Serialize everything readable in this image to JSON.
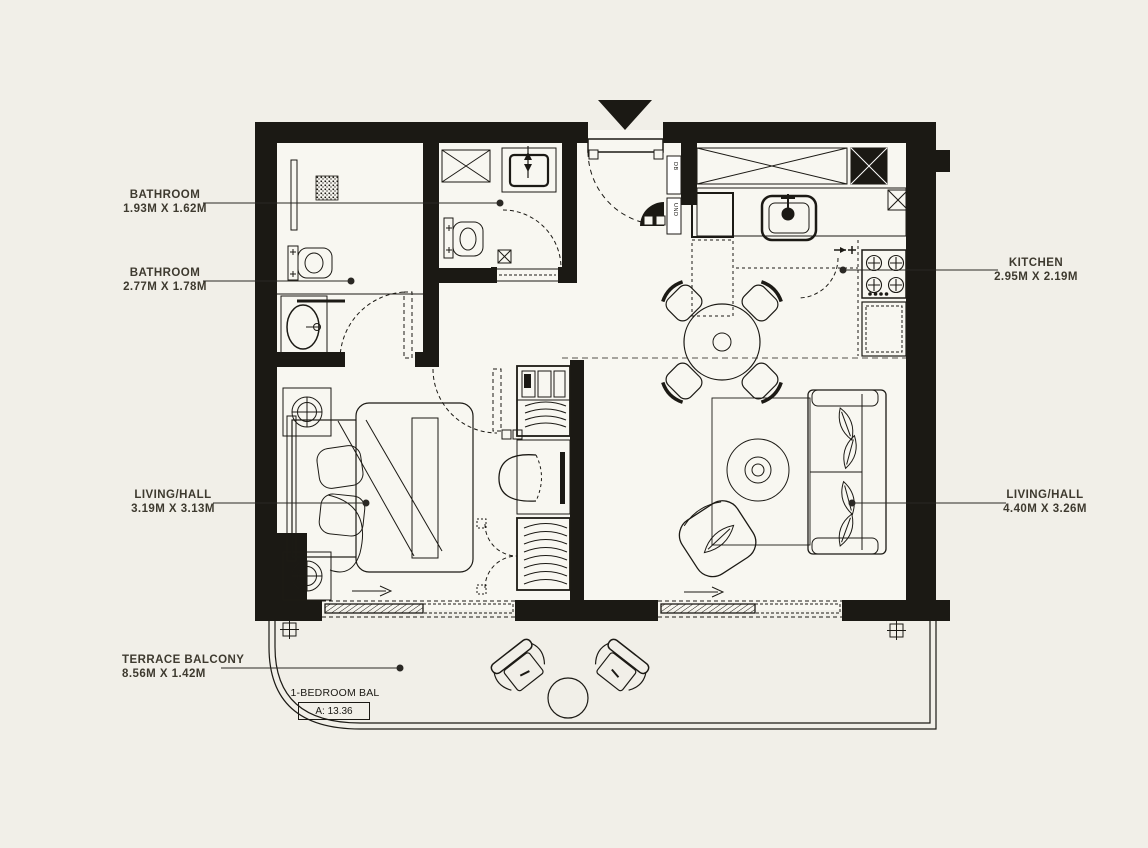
{
  "meta": {
    "type": "apartment-floor-plan",
    "background_color": "#f1efe8",
    "ink_color": "#1b1914",
    "label_color": "#3e3a2f"
  },
  "labels": {
    "bathroom1": {
      "name": "BATHROOM",
      "dims": "1.93M X 1.62M"
    },
    "bathroom2": {
      "name": "BATHROOM",
      "dims": "2.77M X 1.78M"
    },
    "living_hall_left": {
      "name": "LIVING/HALL",
      "dims": "3.19M X 3.13M"
    },
    "kitchen": {
      "name": "KITCHEN",
      "dims": "2.95M X 2.19M"
    },
    "living_hall_right": {
      "name": "LIVING/HALL",
      "dims": "4.40M X 3.26M"
    },
    "terrace": {
      "name": "TERRACE BALCONY",
      "dims": "8.56M X 1.42M"
    }
  },
  "unit": {
    "type_label": "1-BEDROOM BAL",
    "area_label": "A: 13.36"
  },
  "fixtures": {
    "db_label": "DB",
    "und_label": "UND"
  }
}
